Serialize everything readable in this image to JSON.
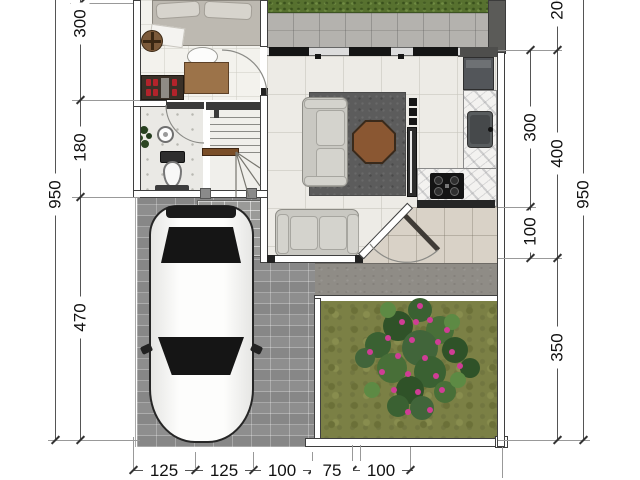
{
  "floor_plan": {
    "type": "residential-floor-plan-top-view",
    "dims": {
      "left_total": "950",
      "left": [
        "300",
        "180",
        "470"
      ],
      "right_inner": [
        "300",
        "100"
      ],
      "right_mid": [
        "200",
        "400",
        "350"
      ],
      "right_total": "950",
      "bottom": [
        "125",
        "125",
        "100",
        "75",
        "100"
      ]
    },
    "areas": [
      "bedroom",
      "bathroom",
      "stairs",
      "living-room",
      "kitchen",
      "entry-porch",
      "carport",
      "garden",
      "terrace-hedge"
    ],
    "colors": {
      "grass": "#7b8045",
      "hedge": "#57712f",
      "paving_brick": "#8e8e8e",
      "concrete": "#8f8c86",
      "rug": "#5c5c5c",
      "wood": "#8a5732",
      "flower_pink": "#cf3d95",
      "marble_counter": "#f3f2f0",
      "dimension_line": "#555555",
      "car_body": "#fbfbfa"
    }
  }
}
